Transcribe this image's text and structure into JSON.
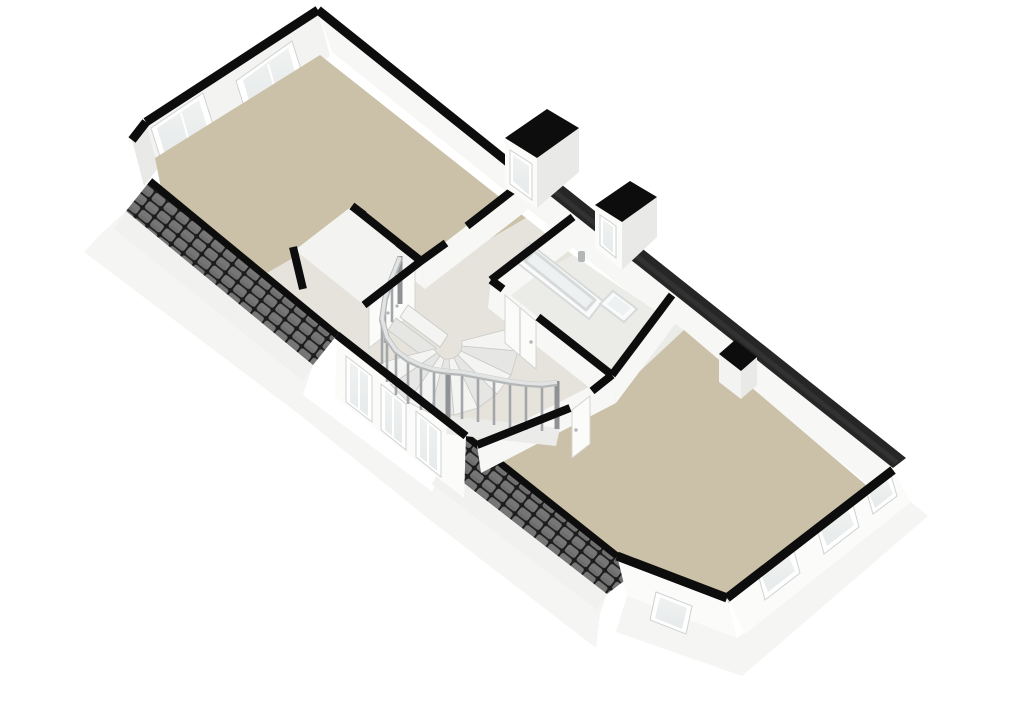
{
  "scene": {
    "type": "3d-floorplan-isometric-cutaway",
    "background": "#ffffff"
  },
  "colors": {
    "background": "#ffffff",
    "floor_tan": "#cbc1a8",
    "floor_light": "#e5e3db",
    "floor_bath": "#ebece8",
    "wall_top": "#0d0d0d",
    "wall_face_bright": "#f7f7f6",
    "wall_face_light": "#f3f3f2",
    "wall_face_shaded": "#e9e9e7",
    "wall_exterior": "#fbfbfa",
    "fascia": "#f1f1f0",
    "base_white": "#f5f5f4",
    "roof_tile": "#767676",
    "roof_tile_dark": "#5d5d5d",
    "roof_grout": "#1c1c1c",
    "roof_edge_dark": "#262626",
    "roof_edge_stripe": "#3b3b3b",
    "glass": "#e7eaea",
    "glass_bright": "#f0f2f2",
    "frame": "#ffffff",
    "frame_stroke": "#cfd2d2",
    "baluster": "#a3a7a9",
    "baluster_dark": "#8e9294",
    "handrail": "#e2e4e4",
    "handrail_shadow": "#b4b7b8",
    "tread_light": "#f4f4f3",
    "tread_dark": "#e6e6e4",
    "tread_stroke": "#c9c9c7",
    "fixture": "#fafafa",
    "fixture_inner": "#eef1f1",
    "fixture_stroke": "#d7dada",
    "metal": "#b2b6b7",
    "door": "#fbfbfa",
    "door_stroke": "#d4d4d2",
    "spandrel": "#ebebe9"
  },
  "rooms": [
    {
      "id": "room-northwest",
      "floor": "tan",
      "windows_gable": 2
    },
    {
      "id": "stair-landing",
      "floor": "light",
      "windows_front": 3
    },
    {
      "id": "bathroom",
      "floor": "light",
      "fixtures": [
        "bathtub",
        "washbasin"
      ]
    },
    {
      "id": "room-southeast",
      "floor": "tan",
      "windows_gable": 4
    }
  ],
  "features": {
    "dormers": 2,
    "staircase": "winder-with-balustrade",
    "doors": [
      "closet-double-door",
      "bathroom-door",
      "bedroom-door"
    ],
    "roof": "dark-tiled-cutaway-bands",
    "chimney": 1
  }
}
